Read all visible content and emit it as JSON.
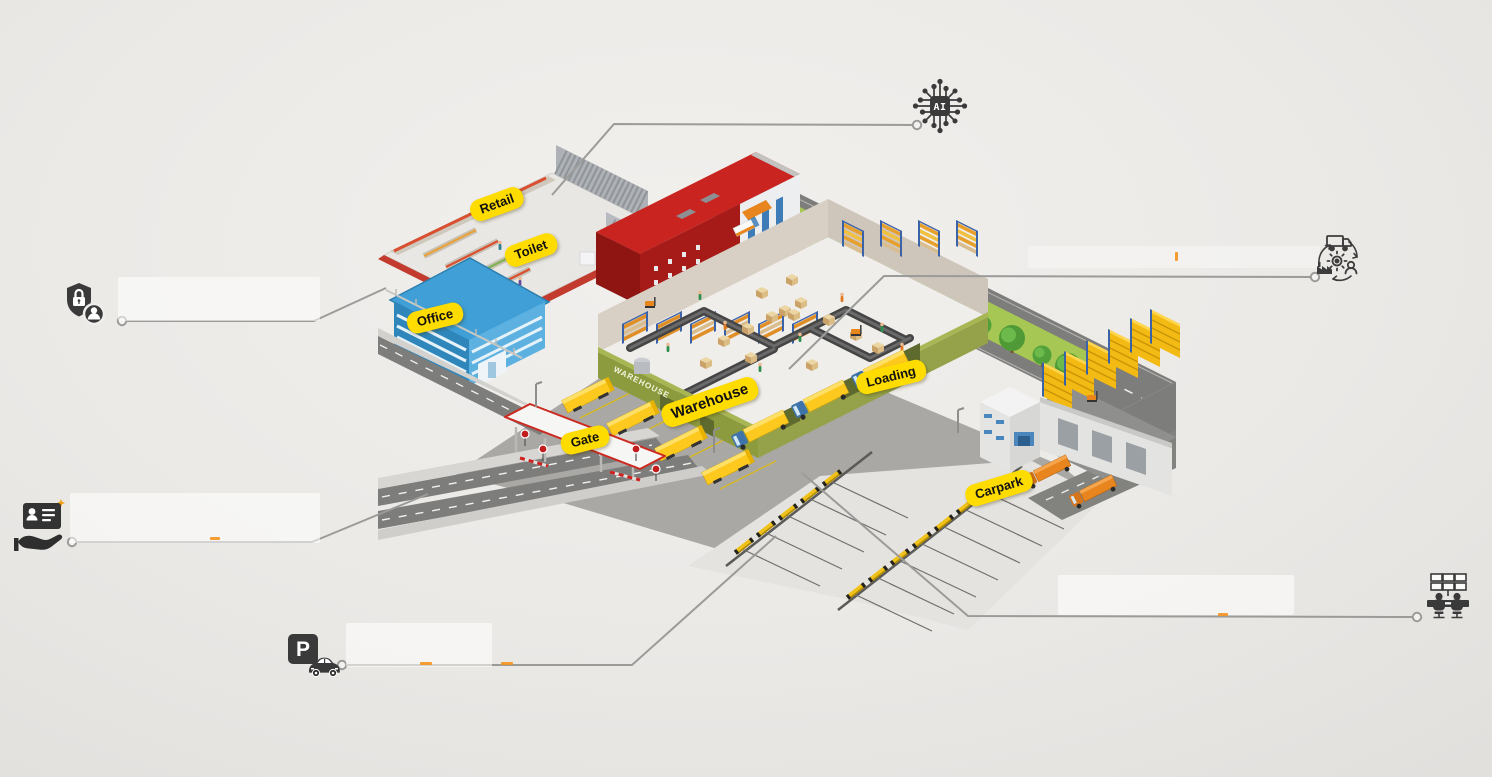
{
  "labels": {
    "retail": "Retail",
    "toilet": "Toilet",
    "office": "Office",
    "gate": "Gate",
    "warehouse": "Warehouse",
    "loading": "Loading",
    "carpark": "Carpark"
  },
  "wall_text": {
    "warehouse": "WAREHOUSE"
  },
  "icons": {
    "ai_chip": {
      "name": "ai-chip-icon",
      "text": "AI"
    },
    "supply_chain": {
      "name": "supply-chain-cycle-icon"
    },
    "security_access": {
      "name": "security-access-icon"
    },
    "id_badge": {
      "name": "id-badge-hand-icon"
    },
    "parking": {
      "name": "parking-car-icon",
      "text": "P"
    },
    "control_room": {
      "name": "control-room-icon"
    }
  },
  "colors": {
    "label_bg": "#FFDC00",
    "label_text": "#111111",
    "callout_line": "#9B9B9A",
    "icon_dark": "#3A3A3A",
    "truck_yellow": "#FEC31D",
    "building_red": "#C9241F",
    "office_blue": "#3F9FD6",
    "warehouse_green": "#8D9B3F",
    "grass_green": "#A6C753",
    "road_gray": "#7D7D7B",
    "yard_gray": "#A9A8A5",
    "carpark_gray": "#E4E3E0"
  }
}
